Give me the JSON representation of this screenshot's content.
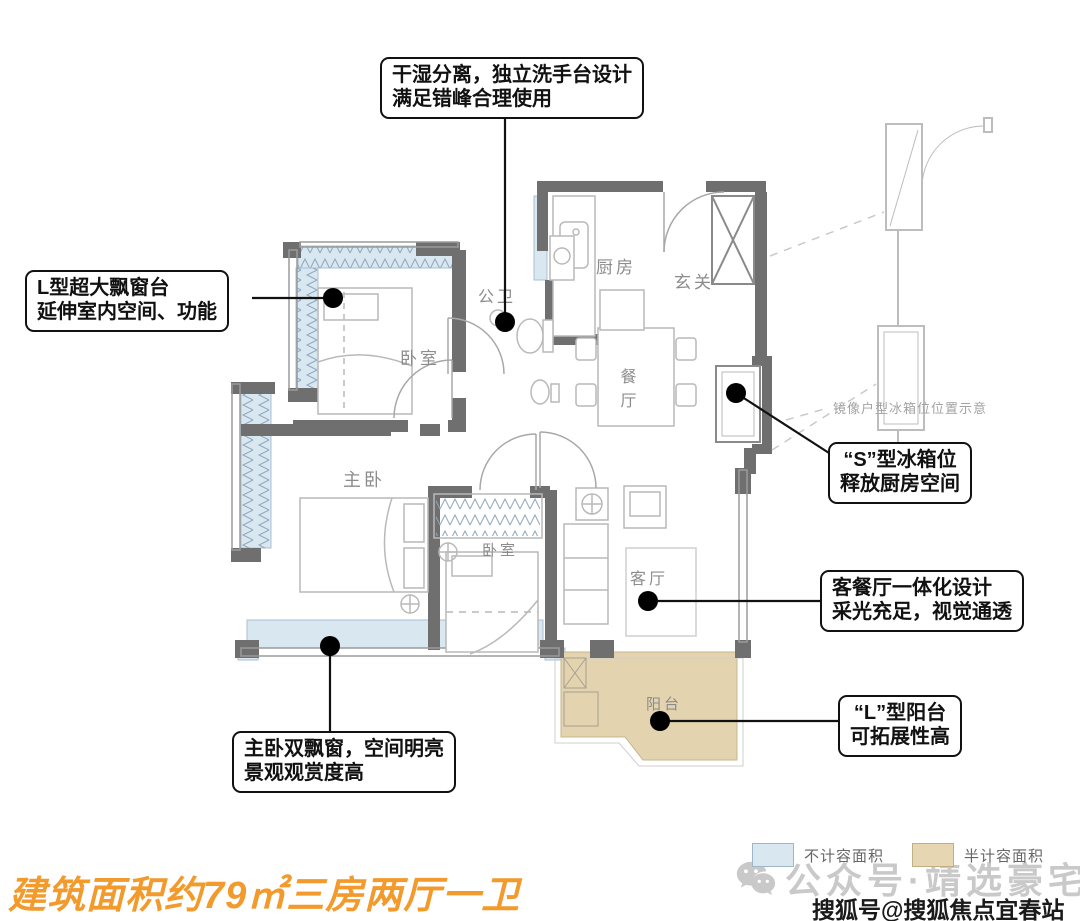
{
  "title": {
    "text": "建筑面积约79㎡三房两厅一卫",
    "color": "#F29A2B"
  },
  "callouts": {
    "washroom": {
      "line1": "干湿分离，独立洗手台设计",
      "line2": "满足错峰合理使用"
    },
    "bay_window": {
      "line1": "L型超大飘窗台",
      "line2": "延伸室内空间、功能"
    },
    "fridge": {
      "line1": "“S”型冰箱位",
      "line2": "释放厨房空间"
    },
    "living_dining": {
      "line1": "客餐厅一体化设计",
      "line2": "采光充足，视觉通透"
    },
    "master_bay": {
      "line1": "主卧双飘窗，空间明亮",
      "line2": "景观观赏度高"
    },
    "balcony": {
      "line1": "“L”型阳台",
      "line2": "可拓展性高"
    }
  },
  "rooms": {
    "bedroom1": "卧室",
    "bathroom": "公卫",
    "kitchen": "厨房",
    "foyer": "玄关",
    "dining_char1": "餐",
    "dining_char2": "厅",
    "master": "主卧",
    "bedroom2": "卧室",
    "living": "客厅",
    "balcony": "阳台"
  },
  "annotations": {
    "mirror_note": "镜像户型冰箱位位置示意"
  },
  "legend": {
    "items": [
      {
        "label": "不计容面积",
        "color": "#D9E7F1"
      },
      {
        "label": "半计容面积",
        "color": "#E6D6B2"
      }
    ]
  },
  "watermarks": {
    "wechat_label": "公众号·靖选豪宅",
    "sohu_label": "搜狐号@搜狐焦点宜春站"
  },
  "palette": {
    "wall": "#6F6F6F",
    "bay_window": "#D9E7F1",
    "balcony": "#E3D3AE",
    "furniture_line": "#B9B9B9",
    "label_text": "#8C8C8C"
  }
}
